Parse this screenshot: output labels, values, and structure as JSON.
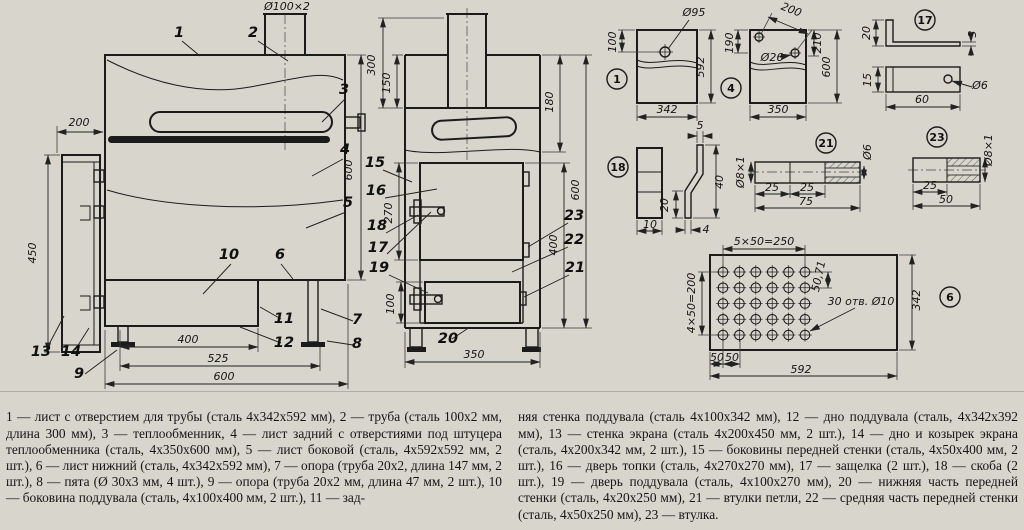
{
  "page": {
    "background": "#d7d5cc",
    "ink": "#1b1b1b"
  },
  "drawing": {
    "labels": [
      {
        "t": "Ø100×2",
        "x": 287,
        "y": 10,
        "fs": 10
      },
      {
        "t": "200",
        "x": 79,
        "y": 126
      },
      {
        "t": "450",
        "x": 36,
        "y": 253,
        "r": -90
      },
      {
        "t": "600",
        "x": 352,
        "y": 170,
        "r": -90
      },
      {
        "t": "400",
        "x": 188,
        "y": 343
      },
      {
        "t": "525",
        "x": 218,
        "y": 362
      },
      {
        "t": "600",
        "x": 224,
        "y": 380
      },
      {
        "t": "300",
        "x": 375,
        "y": 65,
        "r": -90
      },
      {
        "t": "150",
        "x": 390,
        "y": 83,
        "r": -90
      },
      {
        "t": "270",
        "x": 392,
        "y": 213,
        "r": -90
      },
      {
        "t": "100",
        "x": 394,
        "y": 304,
        "r": -90
      },
      {
        "t": "180",
        "x": 553,
        "y": 102,
        "r": -90
      },
      {
        "t": "400",
        "x": 557,
        "y": 245,
        "r": -90
      },
      {
        "t": "600",
        "x": 579,
        "y": 190,
        "r": -90
      },
      {
        "t": "350",
        "x": 474,
        "y": 358
      },
      {
        "t": "Ø95",
        "x": 694,
        "y": 16,
        "fs": 10
      },
      {
        "t": "100",
        "x": 616,
        "y": 42,
        "r": -90,
        "fs": 10
      },
      {
        "t": "592",
        "x": 704,
        "y": 67,
        "r": -90,
        "fs": 10
      },
      {
        "t": "342",
        "x": 667,
        "y": 113,
        "fs": 10
      },
      {
        "t": "200",
        "x": 790,
        "y": 13,
        "r": 22,
        "fs": 10
      },
      {
        "t": "Ø26",
        "x": 772,
        "y": 61,
        "fs": 10
      },
      {
        "t": "190",
        "x": 733,
        "y": 43,
        "r": -90,
        "fs": 10
      },
      {
        "t": "210",
        "x": 821,
        "y": 43,
        "r": -90,
        "fs": 10
      },
      {
        "t": "600",
        "x": 830,
        "y": 67,
        "r": -90,
        "fs": 10
      },
      {
        "t": "350",
        "x": 778,
        "y": 113,
        "fs": 10
      },
      {
        "t": "20",
        "x": 870,
        "y": 33,
        "r": -90,
        "fs": 10
      },
      {
        "t": "3",
        "x": 976,
        "y": 34,
        "r": -90,
        "fs": 9
      },
      {
        "t": "15",
        "x": 871,
        "y": 80,
        "r": -90,
        "fs": 10
      },
      {
        "t": "60",
        "x": 922,
        "y": 103,
        "fs": 10
      },
      {
        "t": "Ø6",
        "x": 980,
        "y": 89,
        "fs": 10
      },
      {
        "t": "10",
        "x": 650,
        "y": 228,
        "fs": 10
      },
      {
        "t": "5",
        "x": 700,
        "y": 129,
        "fs": 10
      },
      {
        "t": "40",
        "x": 723,
        "y": 182,
        "r": -90,
        "fs": 10
      },
      {
        "t": "20",
        "x": 668,
        "y": 205,
        "r": -90,
        "fs": 10
      },
      {
        "t": "4",
        "x": 706,
        "y": 233,
        "fs": 10
      },
      {
        "t": "Ø8×1",
        "x": 744,
        "y": 172,
        "r": -90,
        "fs": 8
      },
      {
        "t": "25",
        "x": 772,
        "y": 191,
        "fs": 9
      },
      {
        "t": "25",
        "x": 807,
        "y": 191,
        "fs": 9
      },
      {
        "t": "75",
        "x": 806,
        "y": 205,
        "fs": 9
      },
      {
        "t": "Ø6",
        "x": 871,
        "y": 152,
        "r": -90,
        "fs": 8
      },
      {
        "t": "Ø8×1",
        "x": 992,
        "y": 150,
        "r": -90,
        "fs": 8
      },
      {
        "t": "25",
        "x": 930,
        "y": 189,
        "fs": 9
      },
      {
        "t": "50",
        "x": 946,
        "y": 203,
        "fs": 9
      },
      {
        "t": "5×50=250",
        "x": 764,
        "y": 245,
        "fs": 9
      },
      {
        "t": "4×50=200",
        "x": 695,
        "y": 303,
        "r": -90,
        "fs": 9
      },
      {
        "t": "50,71",
        "x": 822,
        "y": 277,
        "r": -78,
        "fs": 8
      },
      {
        "t": "30 отв. Ø10",
        "x": 861,
        "y": 305,
        "fs": 9
      },
      {
        "t": "50",
        "x": 717,
        "y": 361,
        "fs": 8
      },
      {
        "t": "50",
        "x": 732,
        "y": 361,
        "fs": 8
      },
      {
        "t": "592",
        "x": 801,
        "y": 373,
        "fs": 10
      },
      {
        "t": "342",
        "x": 920,
        "y": 300,
        "r": -90,
        "fs": 10
      }
    ],
    "callouts": [
      {
        "n": "1",
        "x": 179,
        "y": 37
      },
      {
        "n": "2",
        "x": 253,
        "y": 37
      },
      {
        "n": "3",
        "x": 344,
        "y": 94
      },
      {
        "n": "4",
        "x": 345,
        "y": 154
      },
      {
        "n": "5",
        "x": 348,
        "y": 207
      },
      {
        "n": "6",
        "x": 280,
        "y": 259
      },
      {
        "n": "7",
        "x": 357,
        "y": 324
      },
      {
        "n": "8",
        "x": 357,
        "y": 348
      },
      {
        "n": "9",
        "x": 79,
        "y": 378
      },
      {
        "n": "10",
        "x": 229,
        "y": 259
      },
      {
        "n": "11",
        "x": 284,
        "y": 323
      },
      {
        "n": "12",
        "x": 284,
        "y": 347
      },
      {
        "n": "13",
        "x": 41,
        "y": 356
      },
      {
        "n": "14",
        "x": 71,
        "y": 356
      },
      {
        "n": "15",
        "x": 375,
        "y": 167
      },
      {
        "n": "16",
        "x": 376,
        "y": 195
      },
      {
        "n": "18",
        "x": 377,
        "y": 230
      },
      {
        "n": "17",
        "x": 378,
        "y": 252
      },
      {
        "n": "19",
        "x": 379,
        "y": 272
      },
      {
        "n": "20",
        "x": 448,
        "y": 343
      },
      {
        "n": "23",
        "x": 574,
        "y": 220
      },
      {
        "n": "22",
        "x": 574,
        "y": 244
      },
      {
        "n": "21",
        "x": 575,
        "y": 272
      }
    ],
    "part_circles": [
      {
        "n": "1",
        "x": 617,
        "y": 79
      },
      {
        "n": "4",
        "x": 731,
        "y": 88
      },
      {
        "n": "17",
        "x": 925,
        "y": 20
      },
      {
        "n": "18",
        "x": 618,
        "y": 167
      },
      {
        "n": "21",
        "x": 826,
        "y": 143
      },
      {
        "n": "23",
        "x": 937,
        "y": 137
      },
      {
        "n": "6",
        "x": 950,
        "y": 297
      }
    ],
    "hole_grid": {
      "cols": 6,
      "rows": 5,
      "x0": 723,
      "y0": 272,
      "dx": 16.4,
      "dy": 15.75,
      "r": 4.8
    }
  },
  "legend": {
    "col1": "1 — лист с отверстием для трубы (сталь 4х342х592 мм), 2 — труба (сталь 100х2 мм, длина 300 мм), 3 — теплообменник, 4 — лист задний с отверстиями под штуцера теплообменника (сталь, 4х350х600 мм), 5 — лист боковой (сталь, 4х592х592 мм, 2 шт.), 6 — лист нижний (сталь, 4х342х592 мм), 7 — опора (труба 20х2, длина 147 мм, 2 шт.), 8 — пята (Ø 30х3 мм, 4 шт.), 9 — опора (труба 20х2 мм, длина 47 мм, 2 шт.), 10 — боковина поддувала (сталь, 4х100х400 мм, 2 шт.), 11 — зад-",
    "col2": "няя стенка поддувала (сталь 4х100х342 мм), 12 — дно поддувала (сталь, 4х342х392 мм), 13 — стенка экрана (сталь 4х200х450 мм, 2 шт.), 14 — дно и козырек экрана (сталь, 4х200х342 мм, 2 шт.), 15 — боковины передней стенки (сталь, 4х50х400 мм, 2 шт.), 16 — дверь топки (сталь, 4х270х270 мм), 17 — защелка (2 шт.), 18 — скоба (2 шт.), 19 — дверь поддувала (сталь, 4х100х270 мм), 20 — нижняя часть передней стенки (сталь, 4х20х250 мм), 21 — втулки петли, 22 — средняя часть передней стенки (сталь, 4х50х250 мм), 23 — втулка."
  }
}
